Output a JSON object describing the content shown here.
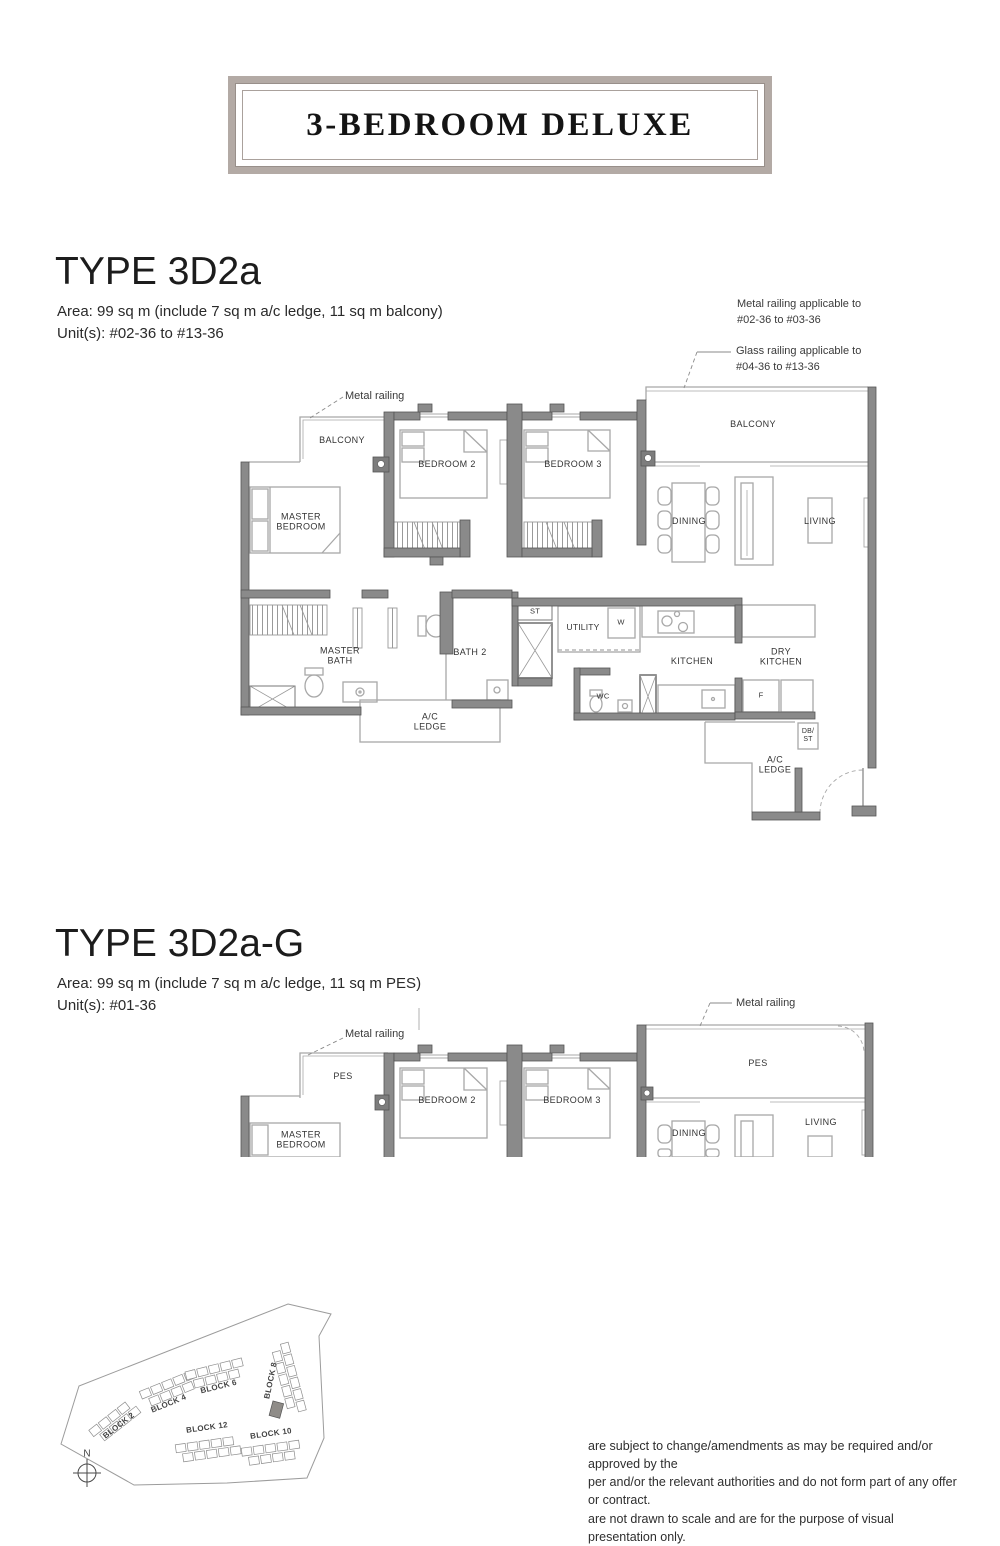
{
  "banner": {
    "title": "3-BEDROOM DELUXE",
    "frame_color": "#b3aaa5"
  },
  "plan1": {
    "title": "TYPE 3D2a",
    "area_line": "Area: 99 sq m (include 7 sq m a/c ledge, 11 sq m balcony)",
    "units_line": "Unit(s): #02-36 to #13-36",
    "annotations": {
      "metal_railing": "Metal railing",
      "metal_range_1": "Metal railing applicable to",
      "metal_range_2": "#02-36 to #03-36",
      "glass_range_1": "Glass railing applicable to",
      "glass_range_2": "#04-36 to #13-36"
    },
    "rooms": {
      "balcony_left": "BALCONY",
      "bedroom2": "BEDROOM 2",
      "bedroom3": "BEDROOM 3",
      "balcony_right": "BALCONY",
      "master_bedroom": "MASTER BEDROOM",
      "dining": "DINING",
      "living": "LIVING",
      "master_bath": "MASTER BATH",
      "bath2": "BATH 2",
      "st": "ST",
      "utility": "UTILITY",
      "washer": "W",
      "kitchen": "KITCHEN",
      "dry_kitchen": "DRY KITCHEN",
      "wc": "WC",
      "fridge": "F",
      "db_st": "DB/ ST",
      "ac_ledge": "A/C LEDGE",
      "ac_ledge_2": "A/C LEDGE"
    }
  },
  "plan2": {
    "title": "TYPE 3D2a-G",
    "area_line": "Area: 99 sq m (include 7 sq m a/c ledge, 11 sq m PES)",
    "units_line": "Unit(s): #01-36",
    "annotations": {
      "metal_railing_left": "Metal railing",
      "metal_railing_right": "Metal railing"
    },
    "rooms": {
      "pes_left": "PES",
      "pes_right": "PES",
      "master_bedroom": "MASTER BEDROOM",
      "bedroom2": "BEDROOM 2",
      "bedroom3": "BEDROOM 3",
      "dining": "DINING",
      "living": "LIVING"
    }
  },
  "site_plan": {
    "blocks": {
      "b2": "BLOCK 2",
      "b4": "BLOCK 4",
      "b6": "BLOCK 6",
      "b8": "BLOCK 8",
      "b12": "BLOCK 12",
      "b10": "BLOCK 10"
    },
    "compass": "N"
  },
  "disclaimer": {
    "line1": "are subject to change/amendments as may be required and/or approved by the",
    "line2": "per and/or the relevant authorities and do not form part of any offer or contract.",
    "line3": "are not drawn to scale and are for the purpose of visual presentation only."
  }
}
